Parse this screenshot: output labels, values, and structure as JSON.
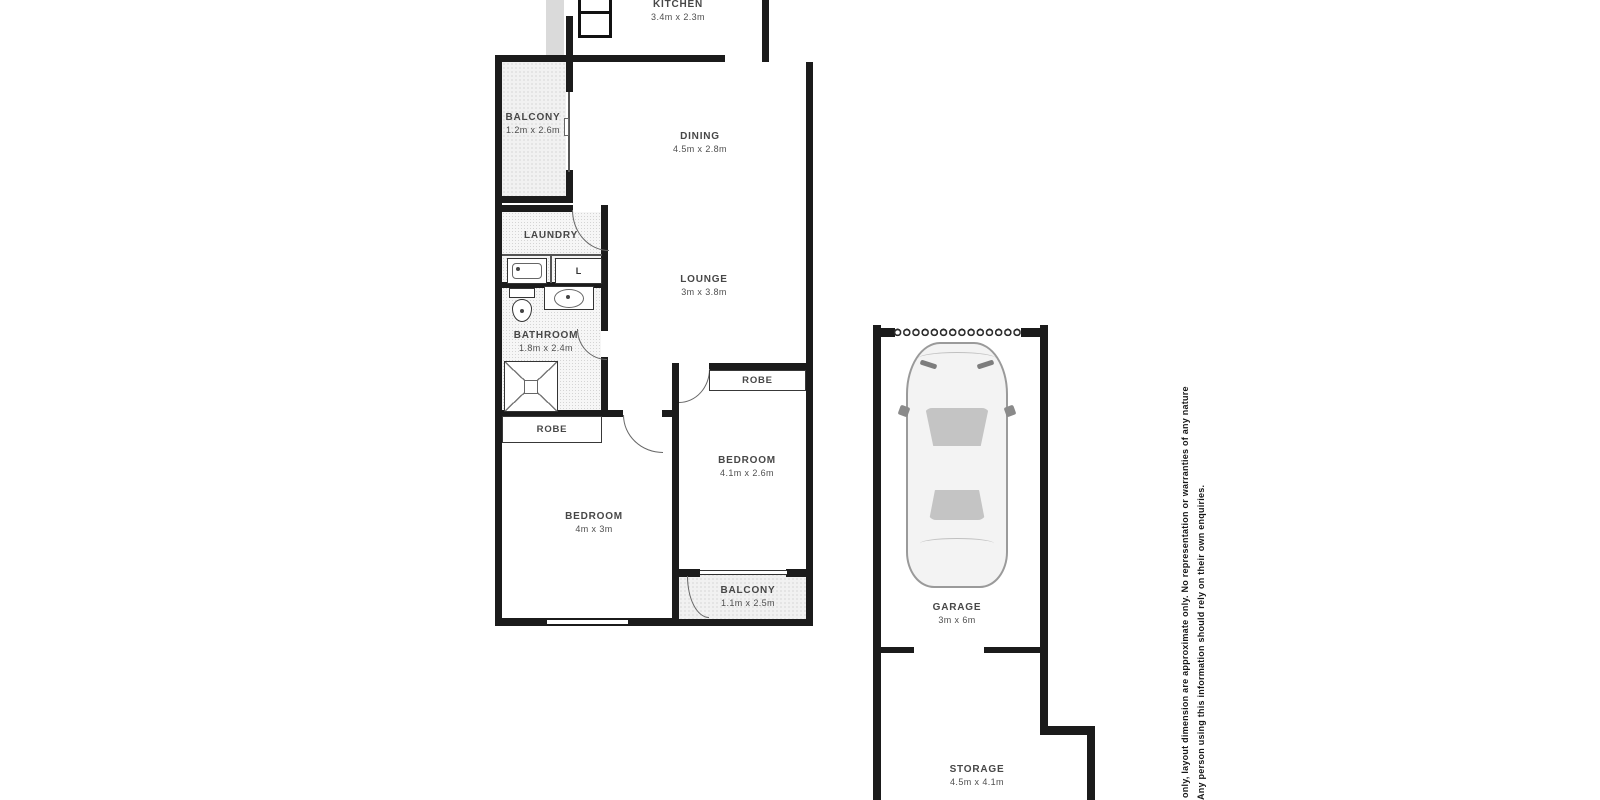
{
  "document": {
    "type": "floor-plan"
  },
  "colors": {
    "wall": "#1b1b1b",
    "label": "#474747",
    "stipple": "#bfbfbf",
    "car_glass": "#c4c4c4"
  },
  "rooms": {
    "kitchen": {
      "name": "KITCHEN",
      "dims": "3.4m x 2.3m"
    },
    "balcony_top": {
      "name": "BALCONY",
      "dims": "1.2m x 2.6m"
    },
    "dining": {
      "name": "DINING",
      "dims": "4.5m x 2.8m"
    },
    "laundry": {
      "name": "LAUNDRY",
      "dims": ""
    },
    "lounge": {
      "name": "LOUNGE",
      "dims": "3m x 3.8m"
    },
    "bathroom": {
      "name": "BATHROOM",
      "dims": "1.8m x 2.4m"
    },
    "robe_left": {
      "name": "ROBE",
      "dims": ""
    },
    "robe_right": {
      "name": "ROBE",
      "dims": ""
    },
    "bedroom_left": {
      "name": "BEDROOM",
      "dims": "4m x 3m"
    },
    "bedroom_right": {
      "name": "BEDROOM",
      "dims": "4.1m x 2.6m"
    },
    "balcony_bottom": {
      "name": "BALCONY",
      "dims": "1.1m x 2.5m"
    },
    "garage": {
      "name": "GARAGE",
      "dims": "3m x 6m"
    },
    "storage": {
      "name": "STORAGE",
      "dims": "4.5m x 4.1m"
    }
  },
  "fixtures": {
    "washer_label": "L"
  },
  "disclaimer": {
    "line1": "e only, layout dimension are approximate only. No representation or warranties of any nature",
    "line2": "Any person using this information should rely on their own enquiries."
  }
}
